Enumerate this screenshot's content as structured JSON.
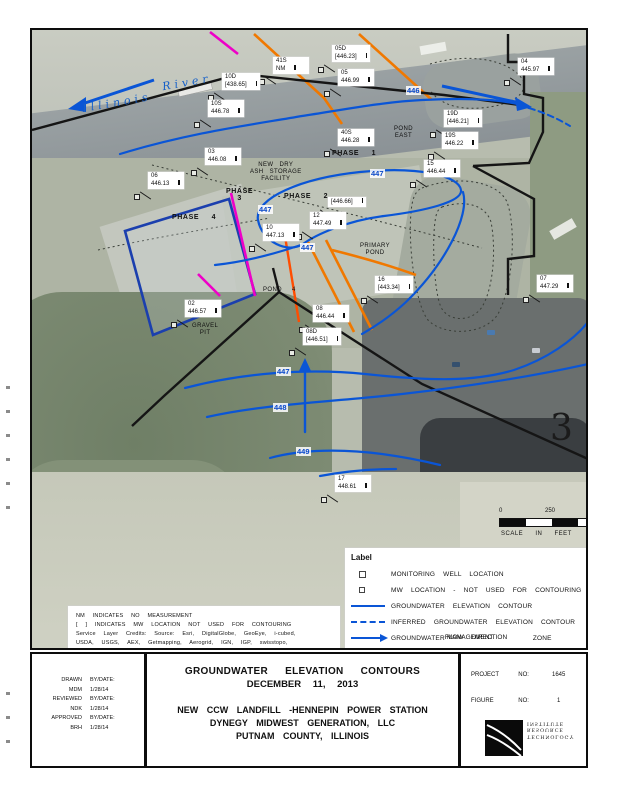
{
  "map": {
    "river": {
      "word1": "Illinois",
      "word2": "River"
    },
    "sheet_number": "3",
    "wells": [
      {
        "id": "41S",
        "value": "NM",
        "x": 271,
        "y": 55
      },
      {
        "id": "10D",
        "value": "[438.65]",
        "x": 220,
        "y": 71
      },
      {
        "id": "10S",
        "value": "446.78",
        "x": 206,
        "y": 98
      },
      {
        "id": "05D",
        "value": "[446.23]",
        "x": 330,
        "y": 43
      },
      {
        "id": "05",
        "value": "446.99",
        "x": 336,
        "y": 67
      },
      {
        "id": "40S",
        "value": "446.28",
        "x": 336,
        "y": 127
      },
      {
        "id": "19D",
        "value": "[446.21]",
        "x": 442,
        "y": 108
      },
      {
        "id": "19S",
        "value": "446.22",
        "x": 440,
        "y": 130
      },
      {
        "id": "04",
        "value": "445.97",
        "x": 516,
        "y": 56
      },
      {
        "id": "03",
        "value": "446.08",
        "x": 203,
        "y": 146
      },
      {
        "id": "06",
        "value": "446.13",
        "x": 146,
        "y": 170
      },
      {
        "id": "15",
        "value": "446.44",
        "x": 422,
        "y": 158
      },
      {
        "id": "",
        "value": "[446.66]",
        "x": 326,
        "y": 195
      },
      {
        "id": "12",
        "value": "447.49",
        "x": 308,
        "y": 210
      },
      {
        "id": "10",
        "value": "447.13",
        "x": 261,
        "y": 222
      },
      {
        "id": "16",
        "value": "[443.34]",
        "x": 373,
        "y": 274
      },
      {
        "id": "07",
        "value": "447.29",
        "x": 535,
        "y": 273
      },
      {
        "id": "02",
        "value": "446.57",
        "x": 183,
        "y": 298
      },
      {
        "id": "08",
        "value": "446.44",
        "x": 311,
        "y": 303
      },
      {
        "id": "08D",
        "value": "[446.51]",
        "x": 301,
        "y": 326
      },
      {
        "id": "17",
        "value": "448.61",
        "x": 333,
        "y": 473
      }
    ],
    "contour_labels": [
      {
        "t": "446",
        "x": 404,
        "y": 84
      },
      {
        "t": "447",
        "x": 368,
        "y": 167
      },
      {
        "t": "447",
        "x": 256,
        "y": 203
      },
      {
        "t": "447",
        "x": 298,
        "y": 241
      },
      {
        "t": "447",
        "x": 274,
        "y": 365
      },
      {
        "t": "448",
        "x": 271,
        "y": 401
      },
      {
        "t": "449",
        "x": 294,
        "y": 445
      }
    ],
    "area_labels": [
      {
        "t": "POND\nEAST",
        "x": 392,
        "y": 124,
        "cls": "c"
      },
      {
        "t": "PHASE 1",
        "x": 330,
        "y": 148,
        "cls": "phase"
      },
      {
        "t": "NEW DRY\nASH STORAGE\nFACILITY",
        "x": 248,
        "y": 160,
        "cls": "c"
      },
      {
        "t": "PHASE\n3",
        "x": 224,
        "y": 186,
        "cls": "phase c"
      },
      {
        "t": "PHASE 2",
        "x": 282,
        "y": 191,
        "cls": "phase"
      },
      {
        "t": "PHASE 4",
        "x": 170,
        "y": 212,
        "cls": "phase"
      },
      {
        "t": "PRIMARY\nPOND",
        "x": 358,
        "y": 241,
        "cls": "c"
      },
      {
        "t": "POND",
        "x": 261,
        "y": 285,
        "cls": ""
      },
      {
        "t": "4",
        "x": 290,
        "y": 285,
        "cls": ""
      },
      {
        "t": "GRAVEL\nPIT",
        "x": 190,
        "y": 321,
        "cls": "c"
      }
    ],
    "scale": {
      "t0": "0",
      "t1": "250",
      "t2": "500",
      "caption": "SCALE IN FEET"
    }
  },
  "legend": {
    "header": "Label",
    "items": [
      {
        "symbol": "square",
        "text": "MONITORING WELL LOCATION"
      },
      {
        "symbol": "square-small",
        "text": "MW LOCATION - NOT USED FOR CONTOURING"
      },
      {
        "symbol": "line-solid",
        "text": "GROUNDWATER ELEVATION CONTOUR"
      },
      {
        "symbol": "line-dashed",
        "text": "INFERRED GROUNDWATER ELEVATION CONTOUR"
      },
      {
        "symbol": "arrow",
        "text": "GROUNDWATER",
        "overlay1": "FLOW DIRECTION",
        "overlay2": "MANAGEMENT",
        "tail": "ZONE"
      }
    ]
  },
  "notes": {
    "lines": [
      "NM INDICATES NO MEASUREMENT",
      "[ ] INDICATES MW LOCATION NOT USED FOR CONTOURING",
      "Service Layer Credits: Source: Esri, DigitalGlobe, GeoEye, i-cubed,",
      "USDA, USGS, AEX, Getmapping, Aerogrid, IGN, IGP, swisstopo,",
      "and the GIS User Community"
    ]
  },
  "admin": {
    "rows": [
      [
        "DRAWN",
        "BY/DATE:"
      ],
      [
        "MDM",
        "1/28/14"
      ],
      [
        "REVIEWED",
        "BY/DATE:"
      ],
      [
        "NDK",
        "1/28/14"
      ],
      [
        "APPROVED",
        "BY/DATE:"
      ],
      [
        "BRH",
        "1/28/14"
      ]
    ]
  },
  "titleblock": {
    "heading": [
      "GROUNDWATER ELEVATION CONTOURS",
      "DECEMBER 11, 2013"
    ],
    "body": [
      "NEW CCW LANDFILL -HENNEPIN POWER STATION",
      "DYNEGY MIDWEST GENERATION, LLC",
      "PUTNAM COUNTY, ILLINOIS"
    ]
  },
  "project": {
    "rows": [
      [
        "PROJECT",
        "NO:",
        "1645"
      ],
      [
        "FIGURE",
        "NO:",
        "1"
      ]
    ]
  },
  "logo": {
    "lines": [
      "TECHNOLOGY",
      "RESOURCE",
      "INSTITUTE"
    ]
  },
  "colors": {
    "contour_blue": "#0a55d6",
    "orange": "#f07800",
    "magenta": "#ee00c8",
    "phase4_blue": "#1b3fae",
    "boundary_black": "#151515"
  }
}
